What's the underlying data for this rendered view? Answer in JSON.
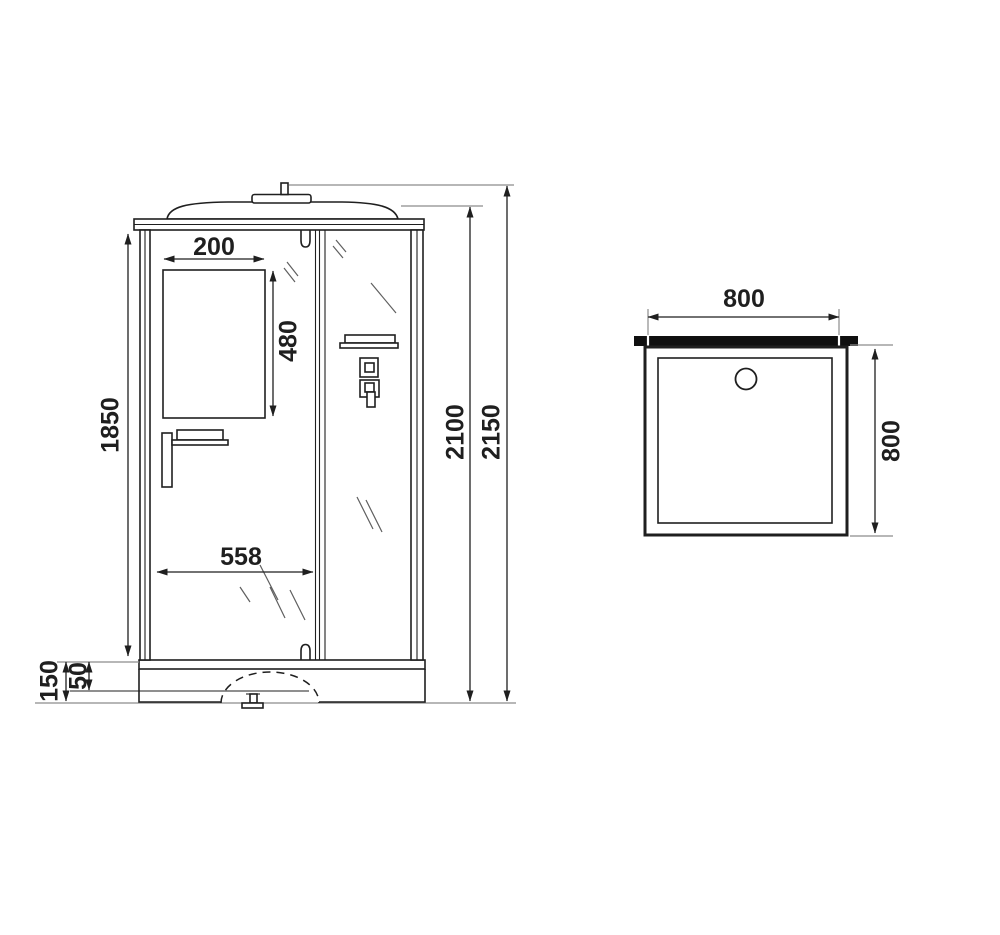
{
  "drawing": {
    "front_view_dimensions": {
      "mirror_width": "200",
      "mirror_height": "480",
      "glass_panel_height": "1850",
      "door_opening_width": "558",
      "cabin_height": "2100",
      "total_height": "2150",
      "tray_total_height": "150",
      "tray_inner_depth": "50"
    },
    "top_view_dimensions": {
      "tray_width": "800",
      "tray_depth": "800"
    },
    "colors": {
      "line_main": "#1f1f1f",
      "line_ext": "#8c8c8c",
      "line_dim": "#1f1f1f",
      "wall_bar": "#0f0f0f",
      "bg": "#ffffff"
    }
  }
}
